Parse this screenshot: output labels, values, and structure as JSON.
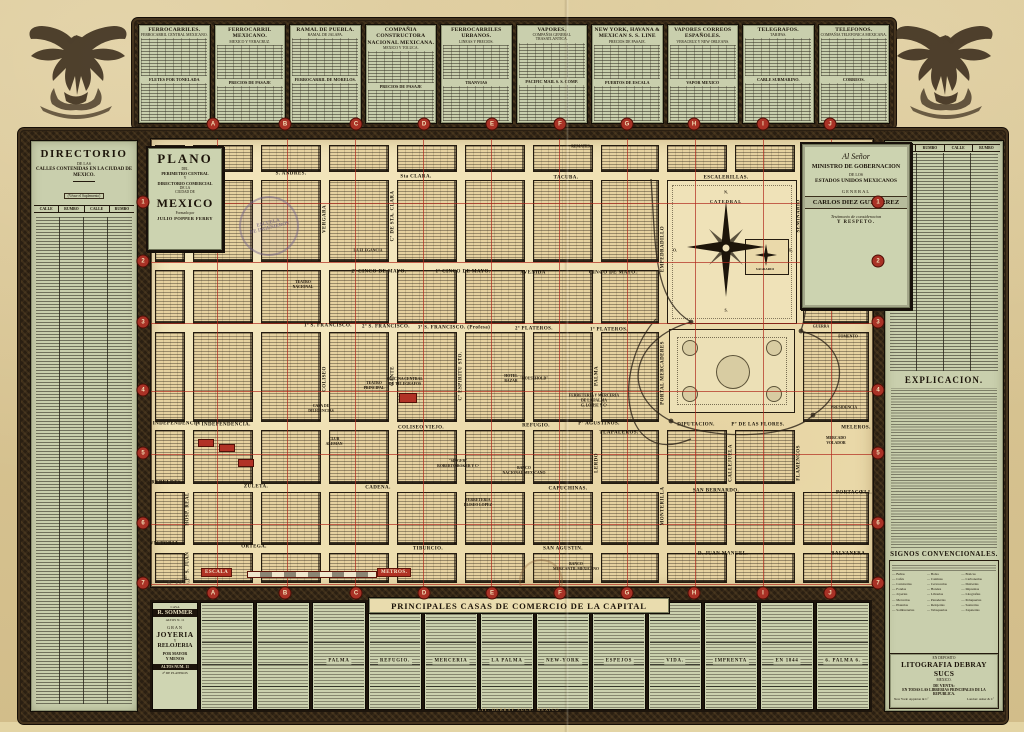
{
  "top_tables": {
    "panels": [
      {
        "title": "FERROCARRILES.",
        "sub": "FERROCARRIL CENTRAL MEXICANO.",
        "mid": "FLETES POR TONELADA"
      },
      {
        "title": "FERROCARRIL MEXICANO.",
        "sub": "MEXICO Y VERACRUZ.",
        "mid": "PRECIOS DE PASAJE"
      },
      {
        "title": "RAMAL DE PUEBLA.",
        "sub": "RAMAL DE JALAPA.",
        "mid": "FERROCARRIL DE MORELOS."
      },
      {
        "title": "COMPAÑIA CONSTRUCTORA NACIONAL MEXICANA.",
        "sub": "MEXICO Y TOLUCA.",
        "mid": "PRECIOS DE PASAJE"
      },
      {
        "title": "FERROCARRILES URBANOS.",
        "sub": "LINEAS Y PRECIOS.",
        "mid": "TRANVIAS"
      },
      {
        "title": "VAPORES.",
        "sub": "COMPAÑIA GENERAL TRASATLANTICA.",
        "mid": "PACIFIC MAIL S. S. COMP."
      },
      {
        "title": "NEW YORK, HAVANA & MEXICAN S. S. LINE",
        "sub": "PRECIOS DE PASAJE.",
        "mid": "PUERTOS DE ESCALA"
      },
      {
        "title": "VAPORES CORREOS ESPAÑOLES.",
        "sub": "VERACRUZ Y NEW ORLEANS.",
        "mid": "VAPOR MEXICO"
      },
      {
        "title": "TELEGRAFOS.",
        "sub": "TARIFAS.",
        "mid": "CABLE SUBMARINO."
      },
      {
        "title": "TELEFONOS.",
        "sub": "COMPAÑIA TELEFONICA MEXICANA.",
        "mid": "CORREOS."
      }
    ]
  },
  "left_directory": {
    "title": "DIRECTORIO",
    "de_las": "DE LAS",
    "subtitle": "CALLES CONTENIDAS EN LA CIUDAD DE MEXICO.",
    "note": "(Véase el Suplemento)",
    "headers": [
      "CALLE",
      "RUMBO",
      "CALLE",
      "RUMBO"
    ]
  },
  "right_panel": {
    "headers": [
      "CALLE",
      "RUMBO",
      "CALLE",
      "RUMBO"
    ],
    "explicacion_title": "EXPLICACION.",
    "signos_title": "SIGNOS CONVENCIONALES.",
    "legend": [
      "Baños",
      "Bolsa",
      "Boticas",
      "Cafés",
      "Cantinas",
      "Carbonerías",
      "Carnicerías",
      "Cervecerías",
      "Dulcerías",
      "Fondas",
      "Hoteles",
      "Imprentas",
      "Joyerías",
      "Librerías",
      "Litografías",
      "Mercerías",
      "Panaderías",
      "Peluquerías",
      "Platerías",
      "Relojerías",
      "Sastrerías",
      "Sombrererías",
      "Tabaquerías",
      "Zapaterías"
    ],
    "deposito": {
      "l1": "EN DEPOSITO",
      "name": "LITOGRAFIA DEBRAY SUCS",
      "city": "MEXICO.",
      "l2": "DE VENTA:",
      "l3": "EN TODAS LAS LIBRERIAS PRINCIPALES DE LA REPUBLICA.",
      "agent1": "New York: Appleton & Cº",
      "agent2": "London: Asher & Cº"
    }
  },
  "cartouche": {
    "l1": "PLANO",
    "l2": "DEL",
    "l3": "PERIMETRO CENTRAL",
    "l4": "Y",
    "l5": "DIRECTORIO COMERCIAL",
    "l6": "DE LA",
    "l7": "CIUDAD DE",
    "l8": "MEXICO",
    "l9": "Formado por",
    "l10": "JULIO POPPER FERRY"
  },
  "dedication": {
    "l1": "Al Señor",
    "l2": "MINISTRO DE GOBERNACION",
    "l3": "DE LOS",
    "l4": "ESTADOS UNIDOS MEXICANOS",
    "l5": "GENERAL",
    "l6": "CARLOS DIEZ GUTIERREZ",
    "l7": "Testimonio de consideracion",
    "l8": "Y RESPETO."
  },
  "stamp": {
    "t1": "ESCUELA",
    "t2": "DE INGENIEROS"
  },
  "map": {
    "grid_letters": [
      {
        "label": "A",
        "x": 213
      },
      {
        "label": "B",
        "x": 285
      },
      {
        "label": "C",
        "x": 356
      },
      {
        "label": "D",
        "x": 424
      },
      {
        "label": "E",
        "x": 492
      },
      {
        "label": "F",
        "x": 560
      },
      {
        "label": "G",
        "x": 627
      },
      {
        "label": "H",
        "x": 694
      },
      {
        "label": "I",
        "x": 763
      },
      {
        "label": "J",
        "x": 830
      }
    ],
    "grid_numbers": [
      {
        "label": "1",
        "y": 202
      },
      {
        "label": "2",
        "y": 261
      },
      {
        "label": "3",
        "y": 322
      },
      {
        "label": "4",
        "y": 390
      },
      {
        "label": "5",
        "y": 453
      },
      {
        "label": "6",
        "y": 523
      },
      {
        "label": "7",
        "y": 583
      }
    ],
    "red_v": [
      {
        "x": 66
      },
      {
        "x": 136
      },
      {
        "x": 204
      },
      {
        "x": 272
      },
      {
        "x": 340
      },
      {
        "x": 408
      },
      {
        "x": 476
      },
      {
        "x": 544
      },
      {
        "x": 612
      },
      {
        "x": 680
      }
    ],
    "red_h": [
      {
        "y": 64
      },
      {
        "y": 123
      },
      {
        "y": 184
      },
      {
        "y": 252
      },
      {
        "y": 315
      },
      {
        "y": 385
      },
      {
        "y": 445
      }
    ],
    "block_cols": [
      [
        4,
        30
      ],
      [
        42,
        60
      ],
      [
        110,
        60
      ],
      [
        178,
        60
      ],
      [
        246,
        60
      ],
      [
        314,
        60
      ],
      [
        382,
        60
      ],
      [
        450,
        58
      ],
      [
        516,
        60
      ],
      [
        584,
        60
      ],
      [
        652,
        66
      ]
    ],
    "block_rows": [
      [
        6,
        27
      ],
      [
        41,
        82
      ],
      [
        131,
        54
      ],
      [
        193,
        90
      ],
      [
        291,
        54
      ],
      [
        353,
        53
      ],
      [
        414,
        30
      ]
    ],
    "block_skip": [
      [
        8,
        1
      ],
      [
        8,
        2
      ],
      [
        8,
        3
      ],
      [
        9,
        1
      ],
      [
        9,
        2
      ],
      [
        9,
        3
      ],
      [
        10,
        4
      ]
    ],
    "h_streets": [
      {
        "label": "S. ANDRES.",
        "x": 140,
        "y": 35
      },
      {
        "label": "Sta CLARA.",
        "x": 265,
        "y": 38
      },
      {
        "label": "TACUBA.",
        "x": 415,
        "y": 39
      },
      {
        "label": "ESCALERILLAS.",
        "x": 575,
        "y": 39
      },
      {
        "label": "2º CINCO DE MAYO.",
        "x": 228,
        "y": 133
      },
      {
        "label": "1º CINCO DE MAYO.",
        "x": 312,
        "y": 133
      },
      {
        "label": "AVENIDA",
        "x": 382,
        "y": 134
      },
      {
        "label": "CINCO DE MAYO.",
        "x": 462,
        "y": 134
      },
      {
        "label": "1ª S. FRANCISCO.",
        "x": 177,
        "y": 187
      },
      {
        "label": "2ª S. FRANCISCO.",
        "x": 235,
        "y": 188
      },
      {
        "label": "3ª S. FRANCISCO. (Profesa)",
        "x": 303,
        "y": 189
      },
      {
        "label": "2ª PLATEROS.",
        "x": 383,
        "y": 190
      },
      {
        "label": "1ª PLATEROS.",
        "x": 458,
        "y": 191
      },
      {
        "label": "ARZOBISPADO.",
        "x": 693,
        "y": 130
      },
      {
        "label": "Pª INDEPENDENCIA",
        "x": 22,
        "y": 285
      },
      {
        "label": "1ª INDEPENDENCIA.",
        "x": 72,
        "y": 286
      },
      {
        "label": "COLISEO VIEJO.",
        "x": 270,
        "y": 289
      },
      {
        "label": "REFUGIO.",
        "x": 385,
        "y": 287
      },
      {
        "label": "Pº AGUSTINOS.",
        "x": 448,
        "y": 285
      },
      {
        "label": "TLAPALEROS.",
        "x": 468,
        "y": 294
      },
      {
        "label": "DIPUTACION.",
        "x": 545,
        "y": 286
      },
      {
        "label": "Pº DE LAS FLORES.",
        "x": 607,
        "y": 286
      },
      {
        "label": "MELEROS.",
        "x": 705,
        "y": 289
      },
      {
        "label": "REBELDES.",
        "x": 16,
        "y": 344
      },
      {
        "label": "ZULETA.",
        "x": 105,
        "y": 348
      },
      {
        "label": "CADENA.",
        "x": 227,
        "y": 349
      },
      {
        "label": "CAPUCHINAS.",
        "x": 417,
        "y": 350
      },
      {
        "label": "SAN BERNARDO.",
        "x": 565,
        "y": 352
      },
      {
        "label": "PORTACŒLI.",
        "x": 703,
        "y": 354
      },
      {
        "label": "VICTORIA.",
        "x": 14,
        "y": 405
      },
      {
        "label": "ORTEGA.",
        "x": 103,
        "y": 408
      },
      {
        "label": "TIBURCIO.",
        "x": 277,
        "y": 410
      },
      {
        "label": "SAN AGUSTIN.",
        "x": 412,
        "y": 410
      },
      {
        "label": "D. JUAN MANUEL.",
        "x": 572,
        "y": 415
      },
      {
        "label": "BALVANERA.",
        "x": 698,
        "y": 415
      }
    ],
    "v_streets": [
      {
        "label": "VERGARA",
        "x": 174,
        "y": 80
      },
      {
        "label": "Cº DE STA. CLARA",
        "x": 242,
        "y": 77
      },
      {
        "label": "COLISEO",
        "x": 174,
        "y": 240
      },
      {
        "label": "GANTE",
        "x": 242,
        "y": 237
      },
      {
        "label": "Cº ESPIRITU STO.",
        "x": 310,
        "y": 237
      },
      {
        "label": "PALMA",
        "x": 446,
        "y": 237
      },
      {
        "label": "LERDO",
        "x": 446,
        "y": 324
      },
      {
        "label": "EMPEDRADILLO",
        "x": 512,
        "y": 110
      },
      {
        "label": "PORTAL MERCADERES",
        "x": 512,
        "y": 234
      },
      {
        "label": "SEMINARIO",
        "x": 648,
        "y": 77
      },
      {
        "label": "MONTERILLA",
        "x": 512,
        "y": 367
      },
      {
        "label": "CALLEJUELA",
        "x": 580,
        "y": 324
      },
      {
        "label": "FLAMENCOS",
        "x": 648,
        "y": 324
      },
      {
        "label": "HOSP. REAL",
        "x": 37,
        "y": 370
      },
      {
        "label": "Pª S. JUAN",
        "x": 37,
        "y": 427
      }
    ],
    "places": [
      {
        "label": "REMATES.",
        "x": 430,
        "y": 8
      },
      {
        "label": "TEATRO\nNACIONAL",
        "x": 152,
        "y": 146
      },
      {
        "label": "LA ELEGANCIA",
        "x": 217,
        "y": 112
      },
      {
        "label": "TEATRO\nPRINCIPAL",
        "x": 223,
        "y": 247
      },
      {
        "label": "OFICINA CENTRAL\nDE TELEGRAFOS",
        "x": 254,
        "y": 243
      },
      {
        "label": "CASA DE\nDILIGENCIAS",
        "x": 170,
        "y": 270
      },
      {
        "label": "CLUB\nALEMAN",
        "x": 183,
        "y": 303
      },
      {
        "label": "\"SINGER\"\nROBERTO BOKER Y Cª",
        "x": 307,
        "y": 325
      },
      {
        "label": "BANCO\nNACIONAL MEXICANO",
        "x": 373,
        "y": 332
      },
      {
        "label": "FERRETERIA\nELISEO LOPEZ",
        "x": 327,
        "y": 364
      },
      {
        "label": "BANCO\nMERCANTIL MEXICANO",
        "x": 425,
        "y": 428
      },
      {
        "label": "HOTEL\nBAZAR",
        "x": 360,
        "y": 240
      },
      {
        "label": "\"HOUSEHOLD\"",
        "x": 383,
        "y": 240
      },
      {
        "label": "FERRETERIA Y MERCERIA\nDE LA PALMA\nG. LOHSE Y Cª",
        "x": 443,
        "y": 262
      },
      {
        "label": "HACIENDA",
        "x": 693,
        "y": 145
      },
      {
        "label": "GUERRA",
        "x": 670,
        "y": 188
      },
      {
        "label": "FOMENTO",
        "x": 697,
        "y": 198
      },
      {
        "label": "PRESIDENCIA",
        "x": 693,
        "y": 269
      },
      {
        "label": "MERCADO\nVOLADOR",
        "x": 685,
        "y": 302
      }
    ],
    "cathedral": {
      "label": "CATEDRAL",
      "sagrario": "SAGRARIO",
      "n": "N.",
      "s": "S.",
      "e": "E.",
      "o": "O."
    },
    "scale": {
      "escala": "ESCALA",
      "metros": "METROS.",
      "pencil": "A. 1903"
    }
  },
  "commerce": {
    "banner": "PRINCIPALES CASAS DE COMERCIO DE LA CAPITAL",
    "imprint": "LIT. DEBRAY SUCS. MEXICO.",
    "sommer": {
      "casa": "CASA",
      "name": "R. SOMMER",
      "altos": "ALTOS N. 11",
      "gran": "GRAN",
      "joyeria": "JOYERIA",
      "y1": "Y",
      "reloj": "RELOJERIA",
      "pm": "POR MAYOR",
      "menos": "Y MENOS",
      "altos2": "ALTOS NUM. 11",
      "plateros": "2ª DE PLATEROS"
    },
    "columns": [
      {
        "label": ""
      },
      {
        "label": ""
      },
      {
        "label": "PALMA"
      },
      {
        "label": "REFUGIO."
      },
      {
        "label": "MERCERIA"
      },
      {
        "label": "LA PALMA"
      },
      {
        "label": "NEW-YORK"
      },
      {
        "label": "ESPEJOS"
      },
      {
        "label": "VIDA."
      },
      {
        "label": "IMPRENTA"
      },
      {
        "label": "EN 1844"
      },
      {
        "label": "6. PALMA 6."
      }
    ]
  }
}
